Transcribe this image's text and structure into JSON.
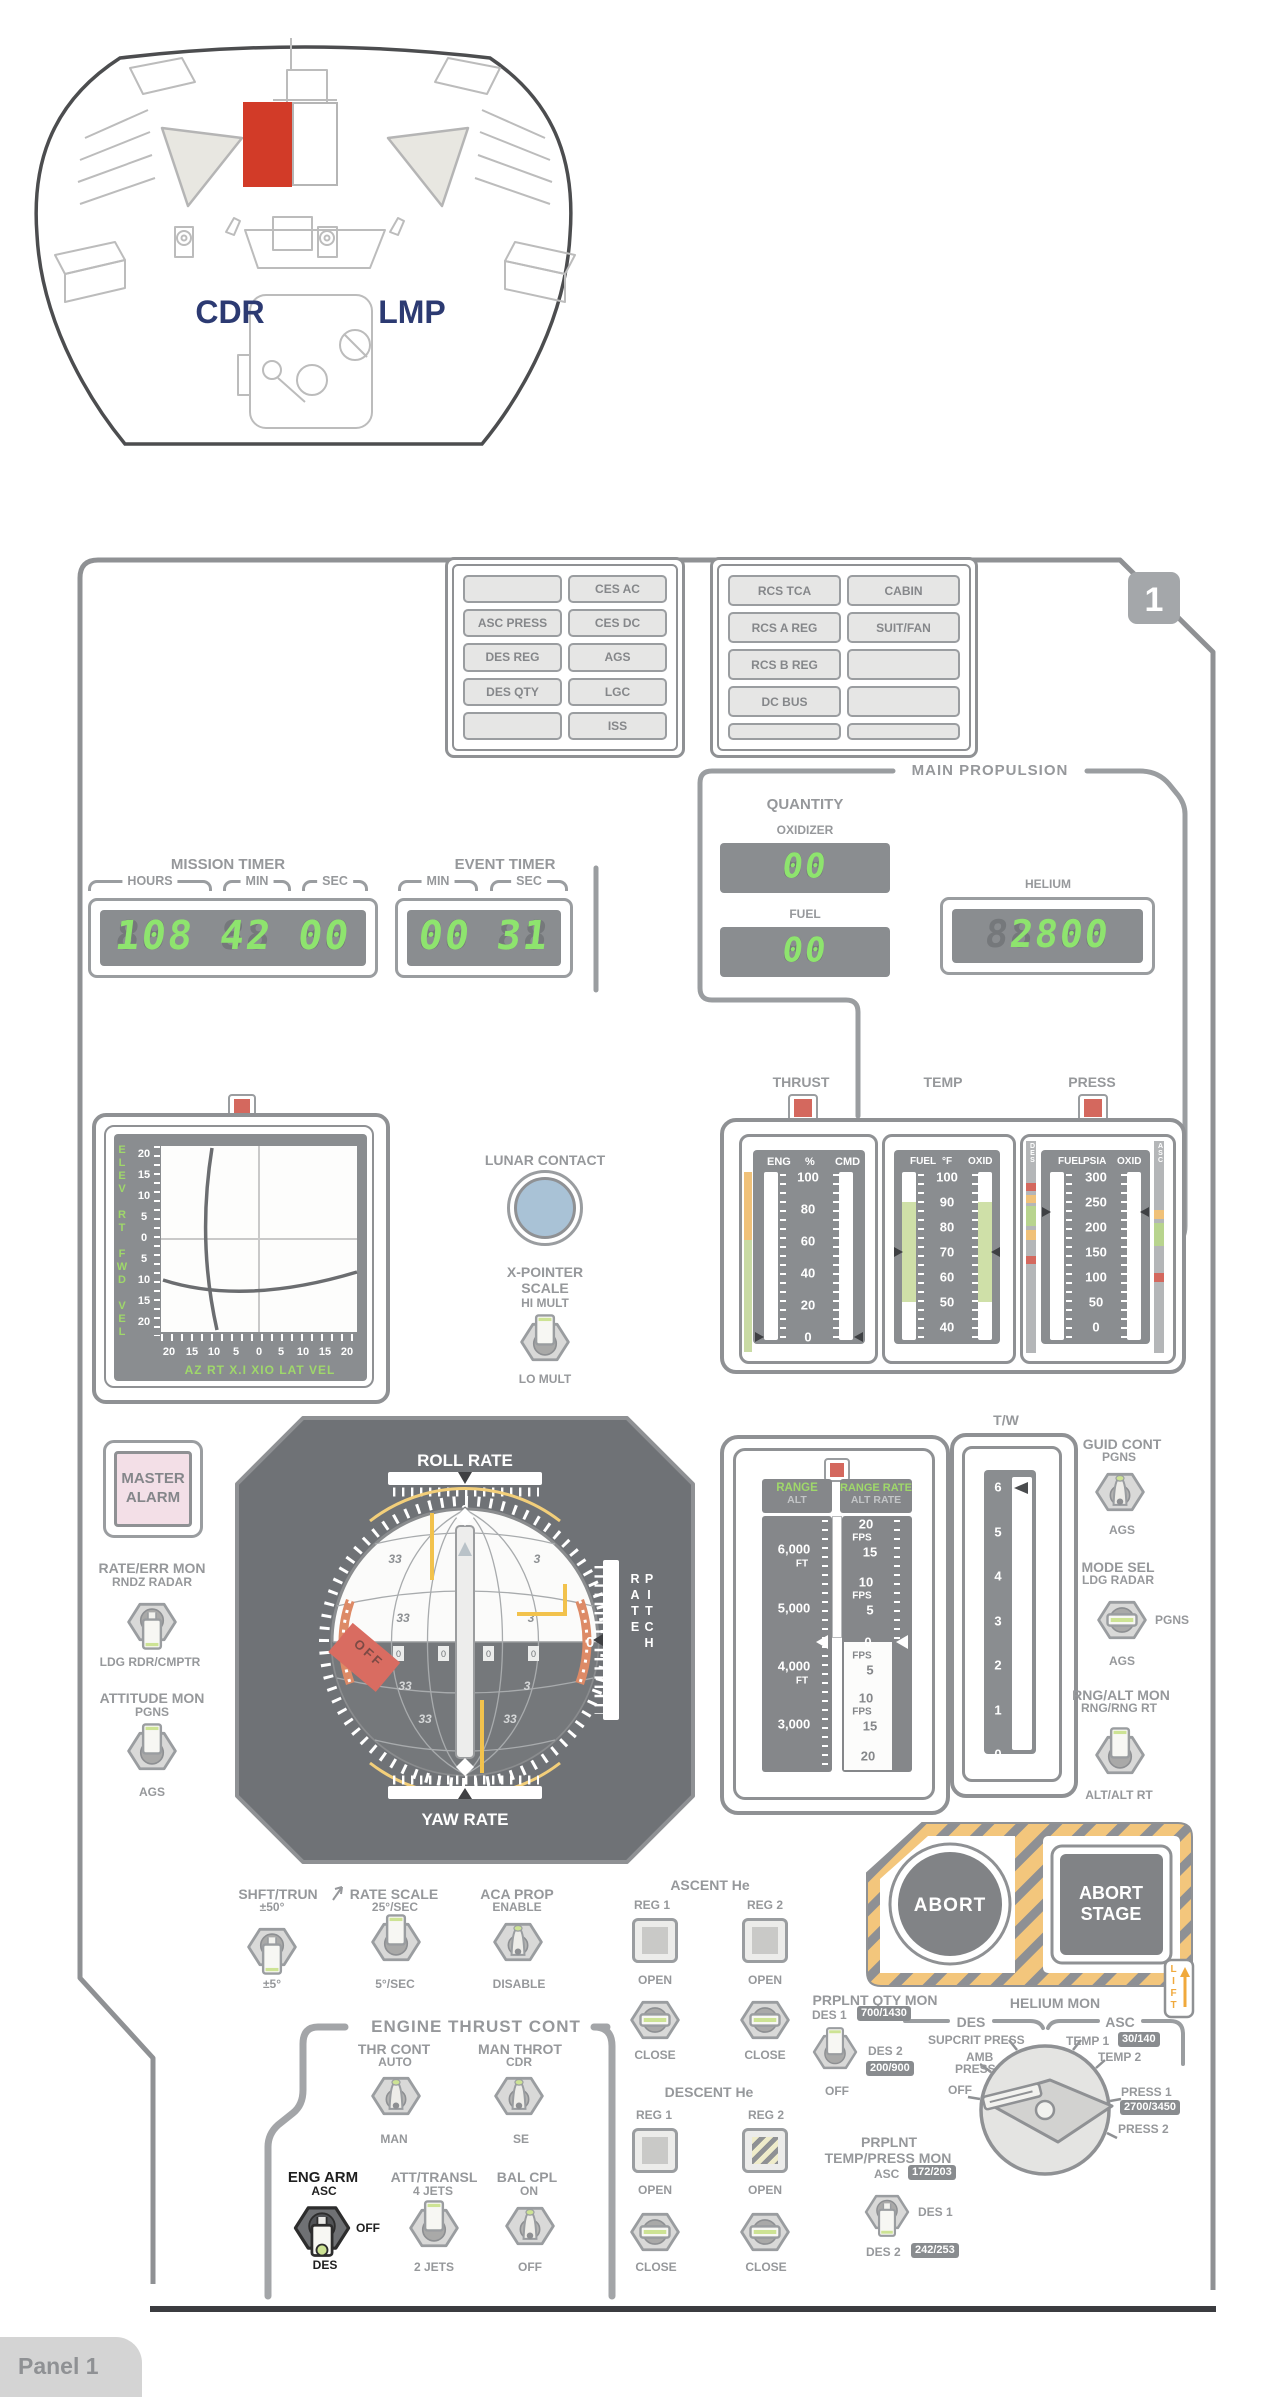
{
  "overview": {
    "cdr": "CDR",
    "lmp": "LMP"
  },
  "panel_num": "1",
  "panel_tab": "Panel 1",
  "cw": {
    "left": [
      [
        "",
        "CES AC"
      ],
      [
        "ASC PRESS",
        "CES DC"
      ],
      [
        "DES REG",
        "AGS"
      ],
      [
        "DES QTY",
        "LGC"
      ],
      [
        "",
        "ISS"
      ]
    ],
    "right": [
      [
        "RCS TCA",
        "CABIN"
      ],
      [
        "RCS A REG",
        "SUIT/FAN"
      ],
      [
        "RCS B REG",
        ""
      ],
      [
        "DC BUS",
        ""
      ],
      [
        "",
        ""
      ]
    ]
  },
  "mission_timer": {
    "title": "MISSION TIMER",
    "hours": "HOURS",
    "min": "MIN",
    "sec": "SEC",
    "ghost": "888 88 88",
    "value": "108 42 00"
  },
  "event_timer": {
    "title": "EVENT TIMER",
    "min": "MIN",
    "sec": "SEC",
    "ghost": "88 88",
    "value": "00 31"
  },
  "mp": {
    "title": "MAIN PROPULSION",
    "quantity": "QUANTITY",
    "oxidizer": "OXIDIZER",
    "oxid_ghost": "88",
    "oxid_value": "00",
    "fuel": "FUEL",
    "fuel_ghost": "88",
    "fuel_value": "00",
    "helium": "HELIUM",
    "helium_ghost": "88888",
    "helium_value": " 2800"
  },
  "thrust": {
    "title": "THRUST",
    "c1": "ENG",
    "c2": "%",
    "c3": "CMD",
    "ticks": [
      "100",
      "80",
      "60",
      "40",
      "20",
      "0"
    ]
  },
  "temp": {
    "title": "TEMP",
    "c1": "FUEL",
    "c2": "°F",
    "c3": "OXID",
    "ticks": [
      "100",
      "90",
      "80",
      "70",
      "60",
      "50",
      "40"
    ]
  },
  "press": {
    "title": "PRESS",
    "c1": "FUEL",
    "c2": "PSIA",
    "c3": "OXID",
    "ticks": [
      "300",
      "250",
      "200",
      "150",
      "100",
      "50",
      "0"
    ],
    "des": "DES",
    "asc": "ASC"
  },
  "xp": {
    "axis_left": "ELEV RT FWD VEL",
    "vticks": [
      "20",
      "15",
      "10",
      "5",
      "0",
      "5",
      "10",
      "15",
      "20"
    ],
    "hticks": [
      "20",
      "15",
      "10",
      "5",
      "0",
      "5",
      "10",
      "15",
      "20"
    ],
    "axis_bottom": "AZ  RT  X.I  XIO  LAT  VEL"
  },
  "lunar_contact": "LUNAR CONTACT",
  "xps": {
    "t1": "X-POINTER",
    "t2": "SCALE",
    "up": "HI MULT",
    "down": "LO MULT"
  },
  "fdai": {
    "roll": "ROLL RATE",
    "pitch": "PITCH RATE",
    "yaw": "YAW RATE",
    "zero": "0",
    "off": "OFF",
    "n33": "33",
    "n3": "3"
  },
  "master_alarm": {
    "l1": "MASTER",
    "l2": "ALARM"
  },
  "rate_err": {
    "title": "RATE/ERR MON",
    "up": "RNDZ RADAR",
    "down": "LDG RDR/CMPTR"
  },
  "att_mon": {
    "title": "ATTITUDE MON",
    "up": "PGNS",
    "down": "AGS"
  },
  "ar": {
    "range": "RANGE",
    "alt": "ALT",
    "range_rate": "RANGE RATE",
    "alt_rate": "ALT RATE",
    "l1": "6,000",
    "l1u": "FT",
    "l2": "5,000",
    "l3": "4,000",
    "l3u": "FT",
    "l4": "3,000",
    "r1": "20",
    "r1u": "FPS",
    "r2": "15",
    "r3": "10",
    "r3u": "FPS",
    "r4": "5",
    "zero": "0",
    "b1": "FPS",
    "b2": "5",
    "b3": "10",
    "b4": "FPS",
    "b5": "15",
    "b6": "20"
  },
  "tw": {
    "title": "T/W",
    "ticks": [
      "6",
      "5",
      "4",
      "3",
      "2",
      "1",
      "0"
    ]
  },
  "guid": {
    "title": "GUID CONT",
    "up": "PGNS",
    "down": "AGS"
  },
  "mode": {
    "title": "MODE SEL",
    "top": "LDG RADAR",
    "right": "PGNS",
    "down": "AGS"
  },
  "rngalt": {
    "title": "RNG/ALT MON",
    "up": "RNG/RNG RT",
    "down": "ALT/ALT RT"
  },
  "abort": {
    "label": "ABORT"
  },
  "abort_stage": {
    "l1": "ABORT",
    "l2": "STAGE",
    "lift": "LIFT"
  },
  "shft": {
    "title": "SHFT/TRUN",
    "up": "±50°",
    "down": "±5°"
  },
  "rate_scale": {
    "title": "RATE SCALE",
    "up": "25°/SEC",
    "down": "5°/SEC"
  },
  "aca": {
    "title": "ACA PROP",
    "up": "ENABLE",
    "down": "DISABLE"
  },
  "asc_he": {
    "title": "ASCENT He",
    "reg1": "REG 1",
    "reg2": "REG 2",
    "open": "OPEN",
    "close": "CLOSE"
  },
  "des_he": {
    "title": "DESCENT He",
    "reg1": "REG 1",
    "reg2": "REG 2",
    "open": "OPEN",
    "close": "CLOSE"
  },
  "etc": {
    "title": "ENGINE THRUST CONT"
  },
  "thr": {
    "title": "THR CONT",
    "up": "AUTO",
    "down": "MAN"
  },
  "man_throt": {
    "title": "MAN THROT",
    "up": "CDR",
    "down": "SE"
  },
  "eng_arm": {
    "title": "ENG ARM",
    "up": "ASC",
    "mid": "OFF",
    "down": "DES"
  },
  "att_transl": {
    "title": "ATT/TRANSL",
    "up": "4 JETS",
    "down": "2 JETS"
  },
  "bal": {
    "title": "BAL CPL",
    "up": "ON",
    "down": "OFF"
  },
  "pqm": {
    "title": "PRPLNT QTY MON",
    "up": "DES 1",
    "up_badge": "700/1430",
    "right": "DES 2",
    "right_badge": "200/900",
    "down": "OFF"
  },
  "hm": {
    "title": "HELIUM MON",
    "des": "DES",
    "asc": "ASC",
    "supcrit": "SUPCRIT PRESS",
    "amb1": "AMB",
    "amb2": "PRESS",
    "off": "OFF",
    "temp1": "TEMP 1",
    "temp1_badge": "30/140",
    "temp2": "TEMP 2",
    "press1": "PRESS 1",
    "press1_badge": "2700/3450",
    "press2": "PRESS 2"
  },
  "ptm": {
    "t1": "PRPLNT",
    "t2": "TEMP/PRESS MON",
    "up": "ASC",
    "up_badge": "172/203",
    "right": "DES 1",
    "down": "DES 2",
    "down_badge": "242/253"
  }
}
